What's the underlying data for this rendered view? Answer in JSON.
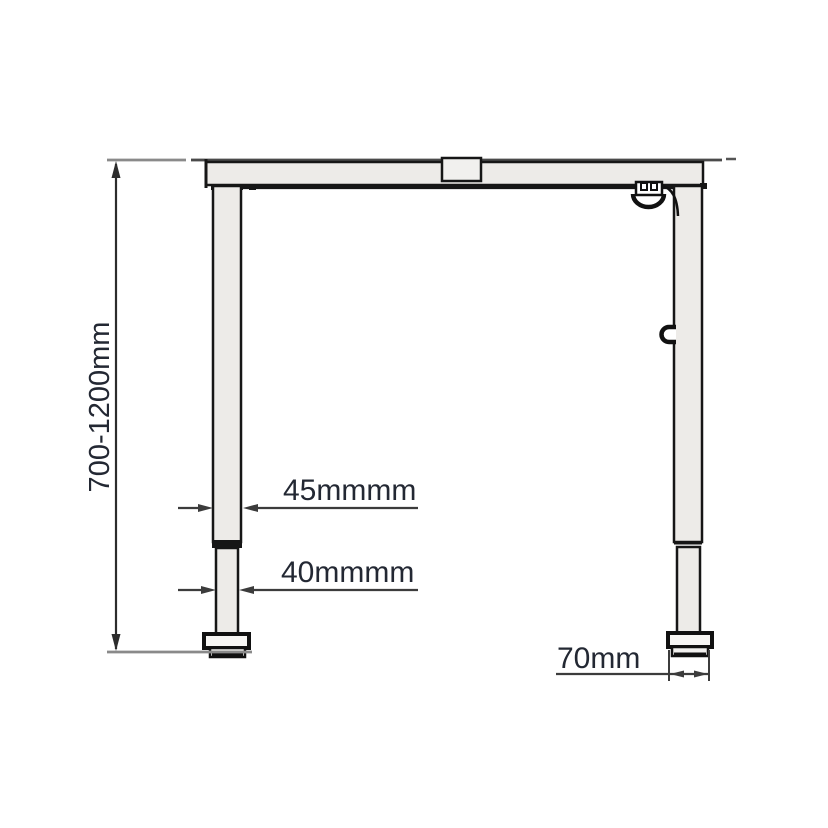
{
  "diagram": {
    "type": "technical-drawing",
    "subject": "height-adjustable desk frame, front elevation",
    "labels": {
      "height_range": "700-1200mm",
      "upper_column_width": "45mmmm",
      "lower_column_width": "40mmmm",
      "foot_width": "70mm"
    },
    "colors": {
      "background": "#ffffff",
      "outline": "#161616",
      "fill_light": "#edebe8",
      "fill_connector": "#f1f0ee",
      "dimension_line": "#3c3c3c",
      "extension_line": "#8a8a8a",
      "label_text": "#232833"
    }
  }
}
